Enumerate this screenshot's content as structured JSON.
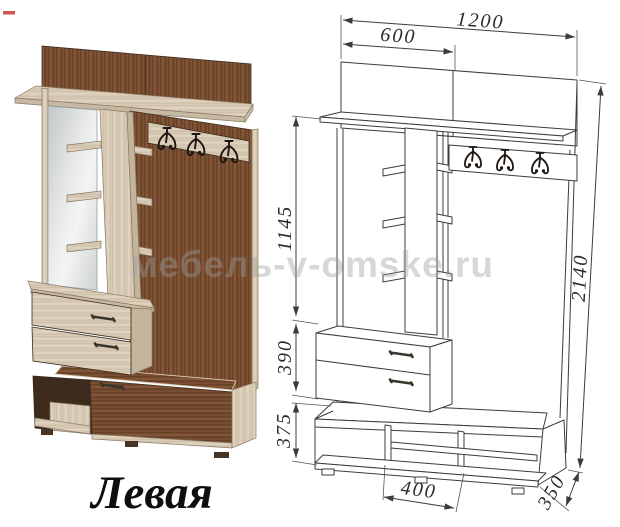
{
  "labels": {
    "variant": "Левая",
    "watermark": "мебель-v-omske.ru"
  },
  "dimensions": {
    "total_width": "1200",
    "left_section_width": "600",
    "upper_section_height": "1145",
    "drawer_unit_height": "390",
    "bench_height": "375",
    "total_height": "2140",
    "center_opening_width": "400",
    "depth": "350"
  },
  "icons": {
    "coat_hook": "coat-hook-icon"
  },
  "colors": {
    "wood_dark": "#7d5134",
    "wood_light": "#d9cbb6",
    "drawing_line": "#3c3c3c",
    "watermark": "#9e9e9e",
    "mirror": "#dfe2e2",
    "label": "#0e0e0e"
  }
}
